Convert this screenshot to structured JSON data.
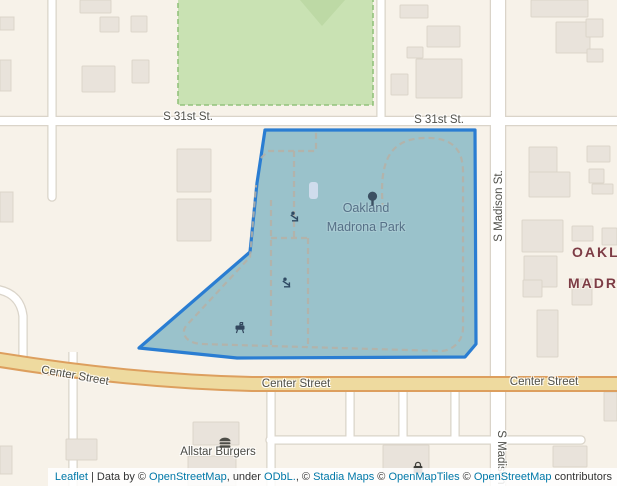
{
  "map": {
    "streets": {
      "s31st_left": "S 31st St.",
      "s31st_right": "S 31st St.",
      "madison_top": "S Madison St.",
      "madison_bottom": "S Madison St.",
      "center_left": "Center Street",
      "center_mid": "Center Street",
      "center_right": "Center Street"
    },
    "park": {
      "line1": "Oakland",
      "line2": "Madrona Park"
    },
    "district": {
      "line1": "OAKLAND",
      "line2": "MADRONA"
    },
    "poi": {
      "allstar_burgers": "Allstar Burgers"
    },
    "icons": {
      "park_symbol": "tree-icon",
      "playground": "playground-icon",
      "barbecue": "bbq-grill-icon",
      "restaurant": "burger-icon",
      "shop": "shopping-bag-icon"
    },
    "colors": {
      "background": "#f7f2e9",
      "polygon_fill": "#9ac2cb",
      "polygon_stroke": "#2a7dd2",
      "major_road_fill": "#eeda9f",
      "major_road_casing": "#dd9f5e",
      "park_green_fill": "#c9e2b3",
      "park_label_color": "#567087",
      "district_label_color": "#7d3c45",
      "attribution_link_color": "#0078a8"
    }
  },
  "attribution": {
    "parts": [
      {
        "text": "Leaflet",
        "link": true
      },
      {
        "text": " | Data by © ",
        "link": false
      },
      {
        "text": "OpenStreetMap",
        "link": true
      },
      {
        "text": ", under ",
        "link": false
      },
      {
        "text": "ODbL.",
        "link": true
      },
      {
        "text": ", © ",
        "link": false
      },
      {
        "text": "Stadia Maps",
        "link": true
      },
      {
        "text": " © ",
        "link": false
      },
      {
        "text": "OpenMapTiles",
        "link": true
      },
      {
        "text": " © ",
        "link": false
      },
      {
        "text": "OpenStreetMap",
        "link": true
      },
      {
        "text": " contributors",
        "link": false
      }
    ]
  }
}
